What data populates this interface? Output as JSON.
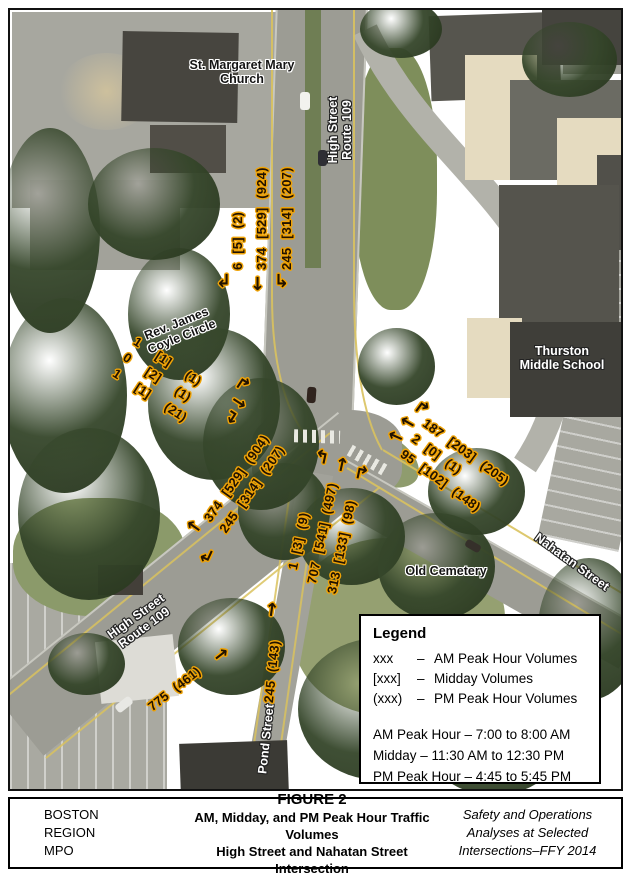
{
  "map_labels": {
    "church": "St. Margaret Mary\nChurch",
    "high_street_top": "High Street\nRoute 109",
    "coyle_circle": "Rev. James\nCoyle Circle",
    "school": "Thurston\nMiddle School",
    "cemetery": "Old Cemetery",
    "nahatan": "Nahatan Street",
    "high_street_sw": "High Street\nRoute 109",
    "pond": "Pond Street"
  },
  "traffic": {
    "north_high_st_approach": {
      "movements": [
        {
          "arrow": "↲",
          "value": "6 [5] (2)"
        },
        {
          "arrow": "↓",
          "value": "374 [529] (924)"
        },
        {
          "arrow": "↳",
          "value": "245 [314] (207)"
        }
      ]
    },
    "coyle_circle_approach": {
      "movements": [
        {
          "arrow": "↱",
          "value": "1 [1] (1)"
        },
        {
          "arrow": "→",
          "value": "0 [2] (1)"
        },
        {
          "arrow": "↴",
          "value": "1 [1] (21)"
        }
      ]
    },
    "nahatan_st_approach": {
      "movements": [
        {
          "arrow": "↱",
          "value": "187 [203] (205)"
        },
        {
          "arrow": "←",
          "value": "2 [0] (1)"
        },
        {
          "arrow": "←",
          "value": "95 [102] (148)"
        }
      ]
    },
    "high_st_sw_approach": {
      "movements": [
        {
          "arrow": "←",
          "value": "374 [529] (904)"
        },
        {
          "arrow": "↲",
          "value": "245 [314] (207)"
        }
      ]
    },
    "pond_st_approach": {
      "movements": [
        {
          "arrow": "↰",
          "value": "1 [3] (9)"
        },
        {
          "arrow": "↑",
          "value": "707 [541] (497)"
        },
        {
          "arrow": "↱",
          "value": "313 [133] (98)"
        }
      ]
    },
    "high_st_eastbound": {
      "movements": [
        {
          "arrow": "→",
          "value": "775 (461)"
        }
      ]
    },
    "pond_st_northbound": {
      "movements": [
        {
          "arrow": "↑",
          "value": "245 (143)"
        }
      ]
    }
  },
  "legend": {
    "title": "Legend",
    "symbols": [
      {
        "symbol": "xxx",
        "dash": "–",
        "label": "AM Peak Hour Volumes"
      },
      {
        "symbol": "[xxx]",
        "dash": "–",
        "label": "Midday Volumes"
      },
      {
        "symbol": "(xxx)",
        "dash": "–",
        "label": "PM Peak Hour Volumes"
      }
    ],
    "periods": [
      "AM Peak Hour – 7:00 to 8:00 AM",
      "Midday – 11:30 AM to 12:30 PM",
      "PM Peak Hour – 4:45 to 5:45 PM"
    ]
  },
  "footer": {
    "org": [
      "BOSTON",
      "REGION",
      "MPO"
    ],
    "figure_no": "FIGURE 2",
    "title_line1": "AM, Midday, and PM Peak Hour Traffic Volumes",
    "title_line2": "High Street and Nahatan Street Intersection",
    "project": [
      "Safety and Operations",
      "Analyses at Selected",
      "Intersections–FFY 2014"
    ]
  },
  "colors": {
    "annotation_text": "#211200",
    "annotation_halo": "#efa307",
    "legend_border": "#000000"
  }
}
